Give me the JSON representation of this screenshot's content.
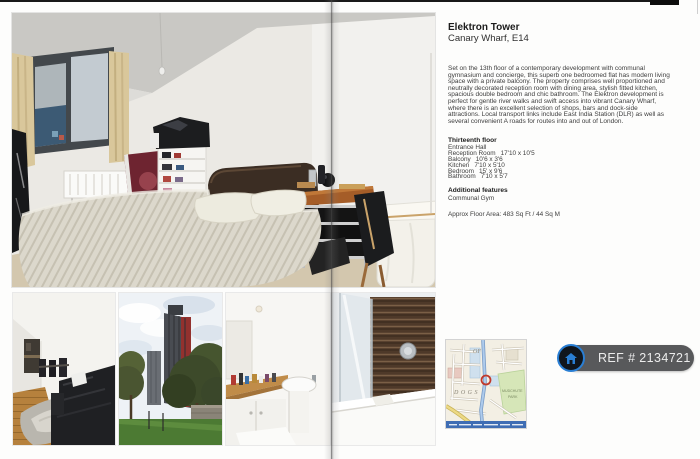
{
  "property": {
    "title": "Elektron Tower",
    "address": "Canary Wharf, E14",
    "description": "Set on the 13th floor of a contemporary development with communal gymnasium and concierge, this superb one bedroomed flat has modern living space with a private balcony. The property comprises well proportioned and neutrally decorated reception room with dining area, stylish fitted kitchen, spacious double bedroom and chic bathroom. The Elektron development is perfect for gentle river walks and swift access into vibrant Canary Wharf, where there is an excellent selection of shops, bars and dock-side attractions. Local transport links include East India Station (DLR) as well as several convenient A roads for routes into and out of London.",
    "floor": {
      "heading": "Thirteenth floor",
      "rooms": [
        {
          "name": "Entrance Hall",
          "size": ""
        },
        {
          "name": "Reception Room",
          "size": "17'10 x 10'5"
        },
        {
          "name": "Balcony",
          "size": "10'6 x 3'6"
        },
        {
          "name": "Kitchen",
          "size": "7'10 x 5'10"
        },
        {
          "name": "Bedroom",
          "size": "15' x 9'6"
        },
        {
          "name": "Bathroom",
          "size": "7'10 x 5'7"
        }
      ]
    },
    "additional": {
      "heading": "Additional features",
      "item": "Communal Gym"
    },
    "floor_area": "Approx Floor Area: 483 Sq Ft / 44 Sq M"
  },
  "ref_badge": {
    "label": "REF # 2134721",
    "icon": "home-icon",
    "background": "#58595b",
    "icon_ring": "#2a7fd4"
  },
  "map": {
    "labels": {
      "of": "OF",
      "dogs": "DOGS",
      "mudchute": "MUDCHUTE",
      "park": "PARK"
    },
    "marker_color": "#c0392b"
  }
}
